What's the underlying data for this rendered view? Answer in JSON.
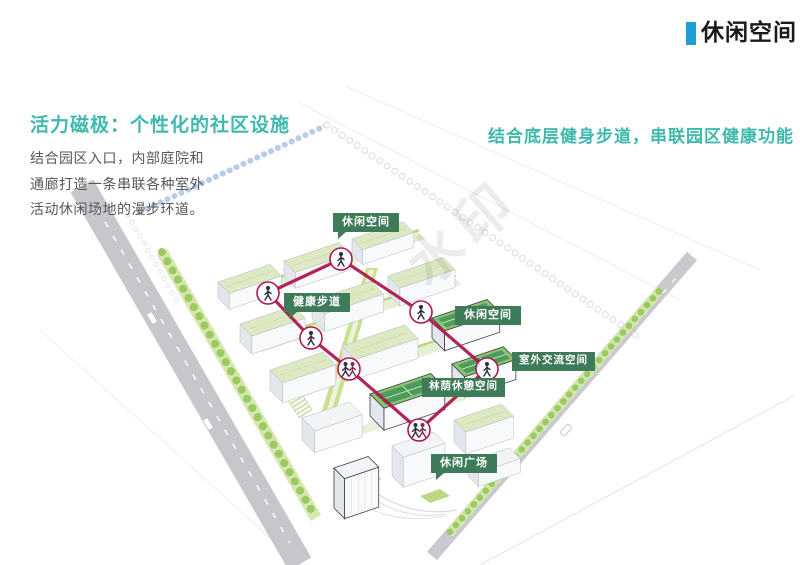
{
  "header": {
    "title": "休闲空间",
    "accent_color": "#1E9FD8"
  },
  "left_panel": {
    "heading": "活力磁极：个性化的社区设施",
    "heading_color": "#3FB9AE",
    "body_lines": [
      "结合园区入口，内部庭院和",
      "通廊打造一条串联各种室外",
      "活动休闲场地的漫步环道。"
    ]
  },
  "subtitle": {
    "text": "结合底层健身步道，串联园区健康功能",
    "color": "#3FB9AE"
  },
  "diagram": {
    "labels": [
      {
        "id": "leisure-space-top",
        "text": "休闲空间"
      },
      {
        "id": "health-trail",
        "text": "健康步道"
      },
      {
        "id": "leisure-space-right",
        "text": "休闲空间"
      },
      {
        "id": "outdoor-exchange",
        "text": "室外交流空间"
      },
      {
        "id": "shaded-rest",
        "text": "林荫休憩空间"
      },
      {
        "id": "leisure-plaza",
        "text": "休闲广场"
      }
    ],
    "label_bg_color": "#3D7B59",
    "route_color": "#AD1950",
    "watermark": "水印"
  }
}
